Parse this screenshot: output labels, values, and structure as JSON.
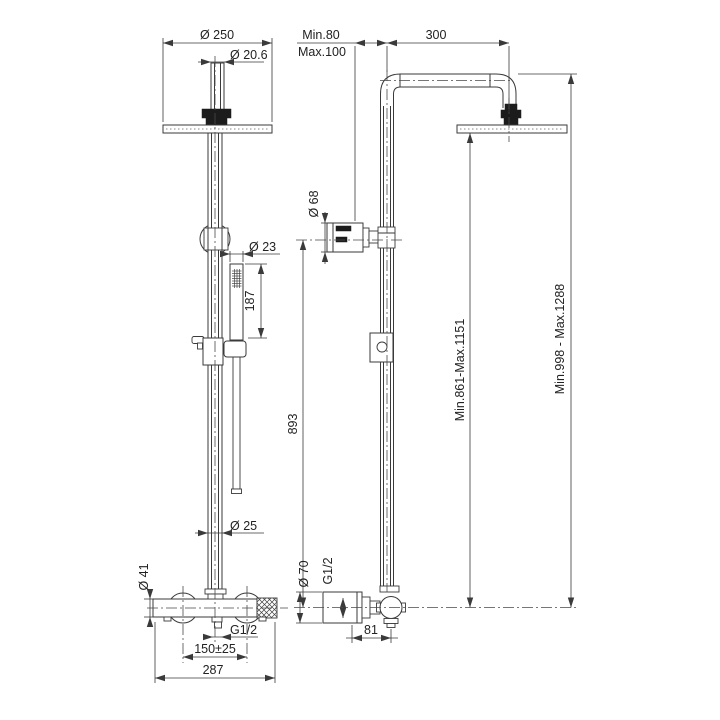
{
  "drawing": {
    "front_view": {
      "head_diameter": "Ø 250",
      "pipe_top_diameter": "Ø 20.6",
      "handshower_diameter": "Ø 23",
      "handshower_length": "187",
      "riser_pipe_diameter": "Ø 25",
      "valve_body_diameter": "Ø 41",
      "outlet_thread": "G1/2",
      "inlet_spacing": "150±25",
      "overall_width": "287"
    },
    "side_view": {
      "wall_distance_min": "Min.80",
      "wall_distance_max": "Max.100",
      "arm_length": "300",
      "bracket_diameter": "Ø 68",
      "riser_height": "893",
      "head_height_range": "Min.861-Max.1151",
      "total_height_range": "Min.998 - Max.1288",
      "valve_depth_diameter": "Ø 70",
      "inlet_thread": "G1/2",
      "valve_offset": "81"
    },
    "line_color": "#3a3a3a",
    "background_color": "#ffffff"
  }
}
